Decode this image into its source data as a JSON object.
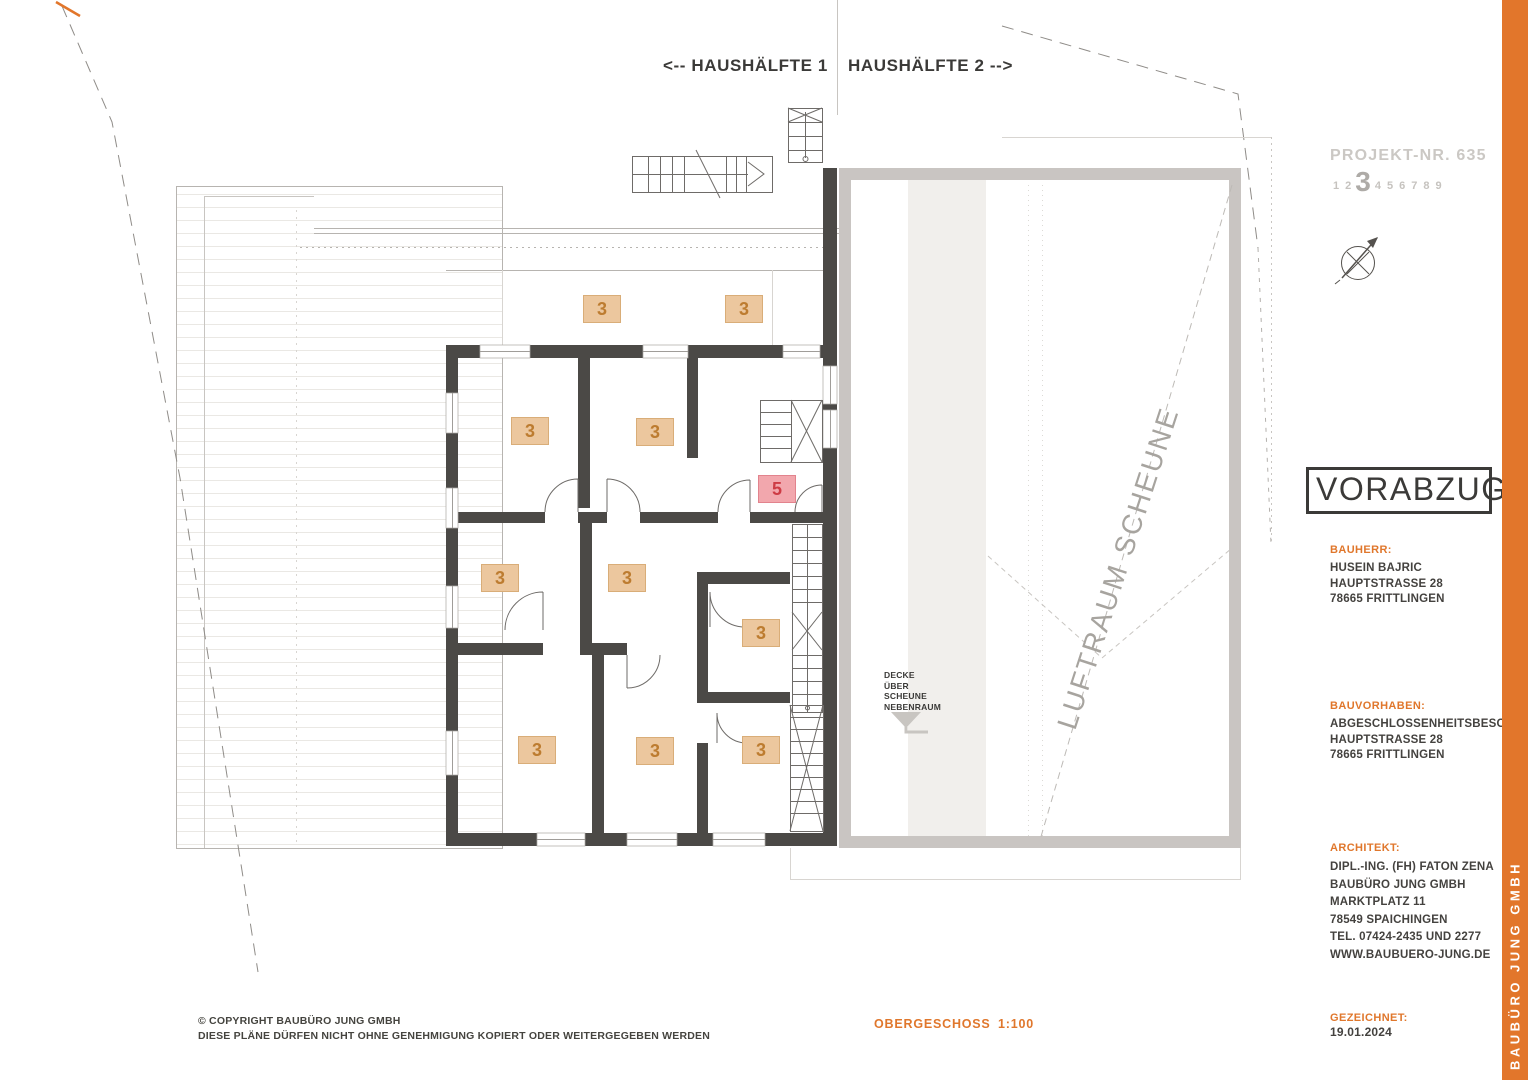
{
  "header": {
    "half1": "<-- HAUSHÄLFTE 1",
    "half2": "HAUSHÄLFTE 2 -->"
  },
  "project": {
    "number_label": "PROJEKT-NR. 635",
    "digits": [
      "1",
      "2",
      "3",
      "4",
      "5",
      "6",
      "7",
      "8",
      "9"
    ],
    "highlight_digit": "3"
  },
  "stamp": {
    "label": "VORABZUG"
  },
  "blocks": {
    "bauherr": {
      "title": "BAUHERR:",
      "lines": [
        "HUSEIN BAJRIC",
        "HAUPTSTRASSE 28",
        "78665 FRITTLINGEN"
      ]
    },
    "bauvorhaben": {
      "title": "BAUVORHABEN:",
      "lines": [
        "ABGESCHLOSSENHEITSBESCHEINIGUNG",
        "HAUPTSTRASSE 28",
        "78665 FRITTLINGEN"
      ]
    },
    "architekt": {
      "title": "ARCHITEKT:",
      "lines": [
        "DIPL.-ING. (FH) FATON ZENA",
        "BAUBÜRO JUNG GMBH",
        "MARKTPLATZ 11",
        "78549 SPAICHINGEN",
        "TEL. 07424-2435 UND 2277",
        "WWW.BAUBUERO-JUNG.DE"
      ]
    }
  },
  "drawn": {
    "title": "GEZEICHNET:",
    "date": "19.01.2024"
  },
  "footer": {
    "copyright_line1": "©  COPYRIGHT BAUBÜRO JUNG GMBH",
    "copyright_line2": "DIESE PLÄNE DÜRFEN NICHT OHNE GENEHMIGUNG KOPIERT ODER WEITERGEGEBEN WERDEN",
    "plan_name": "OBERGESCHOSS",
    "scale": "1:100"
  },
  "sidebar": {
    "brand": "BAUBÜRO JUNG GMBH"
  },
  "plan": {
    "luftraum_label": "LUFTRAUM SCHEUNE",
    "decke_lines": [
      "DECKE",
      "ÜBER",
      "SCHEUNE",
      "NEBENRAUM"
    ],
    "room_markers": [
      {
        "label": "3",
        "x": 602,
        "y": 309,
        "accent": "tan"
      },
      {
        "label": "3",
        "x": 744,
        "y": 309,
        "accent": "tan"
      },
      {
        "label": "3",
        "x": 530,
        "y": 431,
        "accent": "tan"
      },
      {
        "label": "3",
        "x": 655,
        "y": 432,
        "accent": "tan"
      },
      {
        "label": "3",
        "x": 500,
        "y": 578,
        "accent": "tan"
      },
      {
        "label": "3",
        "x": 627,
        "y": 578,
        "accent": "tan"
      },
      {
        "label": "3",
        "x": 761,
        "y": 633,
        "accent": "tan"
      },
      {
        "label": "3",
        "x": 537,
        "y": 750,
        "accent": "tan"
      },
      {
        "label": "3",
        "x": 655,
        "y": 751,
        "accent": "tan"
      },
      {
        "label": "3",
        "x": 761,
        "y": 750,
        "accent": "tan"
      },
      {
        "label": "5",
        "x": 777,
        "y": 489,
        "accent": "pink"
      }
    ]
  },
  "colors": {
    "accent_orange": "#e2762b",
    "wall_dark": "#4b4946",
    "scheune_gray": "#c9c5c2",
    "marker_tan_bg": "#ecc79e",
    "marker_tan_text": "#bd7c30",
    "marker_pink_bg": "#f2a7ad",
    "marker_pink_text": "#ce3b44",
    "faded_gray_text": "#cbc8c4"
  }
}
